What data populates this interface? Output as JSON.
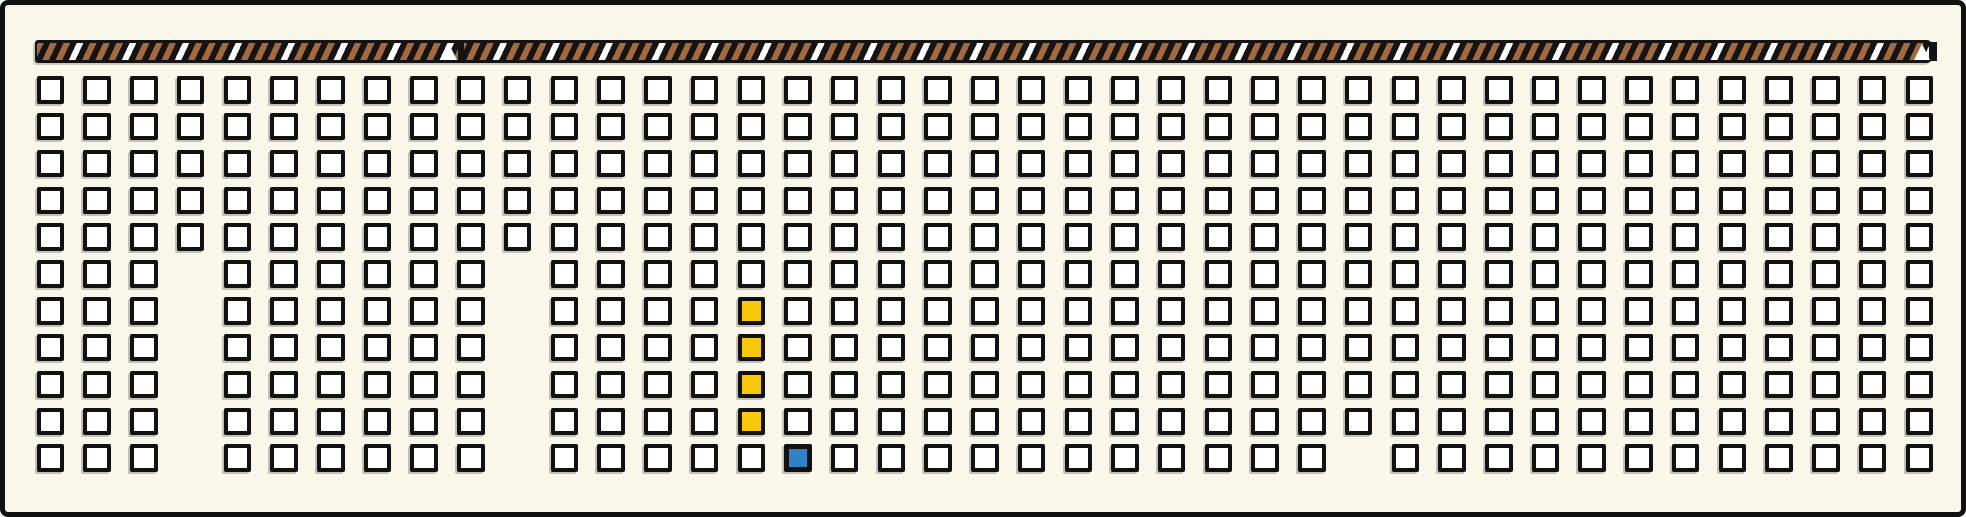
{
  "canvas": {
    "width_px": 1966,
    "height_px": 517,
    "background_color": "#F9F7E9",
    "border_color": "#111111"
  },
  "striped_bar": {
    "description": "horizontal hazard-striped bar across the top",
    "background_color": "#141414",
    "stripe_primary_color": "#A5693C",
    "stripe_accent_color": "#FFFFFF",
    "seams_x_px": [
      449,
      1922
    ]
  },
  "grid": {
    "rows": 11,
    "cols": 41,
    "cell_fill_color": "#FFFFFF",
    "cell_border_color": "#111111",
    "missing_cells": [
      {
        "col": 3,
        "rows": [
          5,
          6,
          7,
          8,
          9,
          10
        ]
      },
      {
        "col": 10,
        "rows": [
          5,
          6,
          7,
          8,
          9,
          10
        ]
      },
      {
        "col": 28,
        "rows": [
          10
        ]
      }
    ],
    "highlighted_cells": {
      "color": "#F8C708",
      "cells": [
        {
          "row": 6,
          "col": 15
        },
        {
          "row": 7,
          "col": 15
        },
        {
          "row": 8,
          "col": 15
        },
        {
          "row": 9,
          "col": 15
        }
      ]
    },
    "selected_cells": {
      "color": "#3082C4",
      "cells": [
        {
          "row": 10,
          "col": 16
        }
      ]
    },
    "counts": {
      "total_boxes": 438,
      "white_boxes": 433,
      "yellow_boxes": 4,
      "blue_boxes": 1
    }
  }
}
